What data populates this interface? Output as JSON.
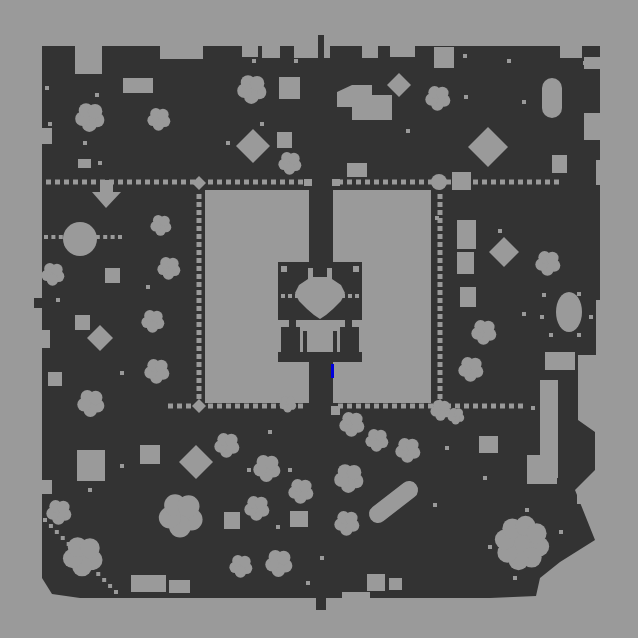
{
  "map": {
    "width": 638,
    "height": 638,
    "colors": {
      "background": "#9a9a9a",
      "terrain": "#333333",
      "clear": "#9a9a9a",
      "marker": "#0000dd"
    },
    "border_polygon": [
      [
        42,
        46
      ],
      [
        600,
        46
      ],
      [
        600,
        300
      ],
      [
        596,
        300
      ],
      [
        596,
        355
      ],
      [
        578,
        355
      ],
      [
        578,
        420
      ],
      [
        595,
        432
      ],
      [
        595,
        470
      ],
      [
        575,
        490
      ],
      [
        595,
        540
      ],
      [
        560,
        562
      ],
      [
        540,
        578
      ],
      [
        536,
        596
      ],
      [
        490,
        598
      ],
      [
        80,
        598
      ],
      [
        52,
        594
      ],
      [
        42,
        578
      ]
    ],
    "notches": [
      [
        75,
        46,
        27,
        28
      ],
      [
        160,
        46,
        43,
        13
      ],
      [
        242,
        46,
        16,
        11
      ],
      [
        262,
        46,
        18,
        12
      ],
      [
        294,
        46,
        36,
        12
      ],
      [
        362,
        46,
        16,
        12
      ],
      [
        390,
        46,
        25,
        11
      ],
      [
        560,
        46,
        22,
        12
      ],
      [
        584,
        57,
        16,
        12
      ],
      [
        584,
        113,
        16,
        27
      ],
      [
        596,
        160,
        8,
        25
      ],
      [
        42,
        128,
        10,
        16
      ],
      [
        42,
        330,
        8,
        18
      ],
      [
        42,
        480,
        10,
        14
      ],
      [
        527,
        455,
        30,
        29
      ],
      [
        577,
        488,
        18,
        16
      ],
      [
        342,
        592,
        28,
        8
      ]
    ],
    "stubs": [
      [
        318,
        35,
        6,
        24
      ],
      [
        316,
        596,
        10,
        14
      ],
      [
        34,
        298,
        8,
        10
      ]
    ],
    "courtyards": [
      [
        205,
        190,
        104,
        213
      ],
      [
        333,
        190,
        98,
        213
      ]
    ],
    "colonnade": {
      "pillar_radius": 7,
      "corner_pillars": [
        [
          199,
          183
        ],
        [
          440,
          183
        ],
        [
          199,
          406
        ],
        [
          440,
          406
        ]
      ],
      "dot_rows": [
        {
          "y": 182,
          "step": 9,
          "size": 5,
          "segments": [
            [
              46,
              194
            ],
            [
              208,
              302
            ],
            [
              338,
              430
            ],
            [
              446,
              560
            ]
          ]
        },
        {
          "y": 406,
          "step": 9,
          "size": 5,
          "segments": [
            [
              168,
              194
            ],
            [
              208,
              302
            ],
            [
              338,
              430
            ],
            [
              446,
              518
            ]
          ]
        }
      ],
      "dot_cols": [
        {
          "x": 199,
          "step": 8,
          "size": 5,
          "segments": [
            [
              194,
              400
            ]
          ]
        },
        {
          "x": 440,
          "step": 8,
          "size": 5,
          "segments": [
            [
              194,
              400
            ]
          ]
        }
      ]
    },
    "dotted_paths": [
      {
        "from": [
          46,
          237
        ],
        "to": [
          120,
          237
        ],
        "step": 7,
        "size": 4
      },
      {
        "from": [
          45,
          520
        ],
        "to": [
          116,
          592
        ],
        "step": 8,
        "size": 4
      }
    ],
    "building": {
      "body": [
        278,
        262,
        84,
        100
      ],
      "fan": [
        [
          308,
          268
        ],
        [
          313,
          268
        ],
        [
          313,
          277
        ],
        [
          327,
          277
        ],
        [
          327,
          268
        ],
        [
          332,
          268
        ],
        [
          332,
          279
        ],
        [
          341,
          285
        ],
        [
          345,
          293
        ],
        [
          341,
          301
        ],
        [
          333,
          309
        ],
        [
          326,
          315
        ],
        [
          320,
          319
        ],
        [
          314,
          315
        ],
        [
          307,
          309
        ],
        [
          299,
          301
        ],
        [
          295,
          293
        ],
        [
          299,
          285
        ],
        [
          308,
          279
        ]
      ],
      "squares": [
        [
          281,
          266,
          6,
          6
        ],
        [
          353,
          266,
          6,
          6
        ]
      ],
      "pillar_dots": [
        [
          283,
          296
        ],
        [
          290,
          296
        ],
        [
          297,
          296
        ],
        [
          343,
          296
        ],
        [
          350,
          296
        ],
        [
          357,
          296
        ]
      ],
      "band": [
        277,
        320,
        86,
        7
      ],
      "band_gaps": [
        [
          289,
          320,
          7,
          7
        ],
        [
          345,
          320,
          7,
          7
        ]
      ],
      "room": [
        300,
        325,
        40,
        27
      ],
      "room_columns": [
        [
          303,
          331,
          4,
          21
        ],
        [
          333,
          331,
          4,
          21
        ]
      ],
      "side_strips": [
        [
          277,
          325,
          4,
          27
        ],
        [
          359,
          325,
          4,
          27
        ]
      ]
    },
    "marker": [
      331,
      364,
      3,
      14
    ],
    "blobs": [
      {
        "shape": "rect",
        "x": 123,
        "y": 78,
        "w": 30,
        "h": 15
      },
      {
        "shape": "tree",
        "cx": 159,
        "cy": 119,
        "r": 11
      },
      {
        "shape": "tree",
        "cx": 90,
        "cy": 117,
        "r": 14
      },
      {
        "shape": "rect",
        "x": 78,
        "y": 159,
        "w": 13,
        "h": 9
      },
      {
        "shape": "poly",
        "pts": [
          [
            100,
            180
          ],
          [
            113,
            180
          ],
          [
            113,
            192
          ],
          [
            121,
            192
          ],
          [
            106,
            208
          ],
          [
            92,
            192
          ],
          [
            100,
            192
          ]
        ]
      },
      {
        "shape": "tree",
        "cx": 53,
        "cy": 274,
        "r": 11
      },
      {
        "shape": "circle",
        "cx": 80,
        "cy": 239,
        "r": 17
      },
      {
        "shape": "rect",
        "x": 105,
        "y": 268,
        "w": 15,
        "h": 15
      },
      {
        "shape": "tree",
        "cx": 161,
        "cy": 225,
        "r": 10
      },
      {
        "shape": "tree",
        "cx": 169,
        "cy": 268,
        "r": 11
      },
      {
        "shape": "rect",
        "x": 75,
        "y": 315,
        "w": 15,
        "h": 15
      },
      {
        "shape": "diamond",
        "cx": 100,
        "cy": 338,
        "r": 13
      },
      {
        "shape": "tree",
        "cx": 153,
        "cy": 321,
        "r": 11
      },
      {
        "shape": "tree",
        "cx": 157,
        "cy": 371,
        "r": 12
      },
      {
        "shape": "rect",
        "x": 48,
        "y": 372,
        "w": 14,
        "h": 14
      },
      {
        "shape": "tree",
        "cx": 91,
        "cy": 403,
        "r": 13
      },
      {
        "shape": "rect",
        "x": 77,
        "y": 450,
        "w": 28,
        "h": 31
      },
      {
        "shape": "tree",
        "cx": 59,
        "cy": 512,
        "r": 12
      },
      {
        "shape": "tree",
        "cx": 83,
        "cy": 556,
        "r": 19
      },
      {
        "shape": "rect",
        "x": 140,
        "y": 445,
        "w": 20,
        "h": 19
      },
      {
        "shape": "diamond",
        "cx": 196,
        "cy": 462,
        "r": 17
      },
      {
        "shape": "tree",
        "cx": 181,
        "cy": 515,
        "r": 21
      },
      {
        "shape": "rect",
        "x": 131,
        "y": 575,
        "w": 35,
        "h": 17
      },
      {
        "shape": "rect",
        "x": 169,
        "y": 580,
        "w": 21,
        "h": 13
      },
      {
        "shape": "tree",
        "cx": 252,
        "cy": 89,
        "r": 14
      },
      {
        "shape": "rect",
        "x": 279,
        "y": 77,
        "w": 21,
        "h": 22
      },
      {
        "shape": "poly",
        "pts": [
          [
            337,
            92
          ],
          [
            352,
            85
          ],
          [
            372,
            85
          ],
          [
            372,
            95
          ],
          [
            392,
            95
          ],
          [
            392,
            120
          ],
          [
            352,
            120
          ],
          [
            352,
            107
          ],
          [
            337,
            107
          ]
        ]
      },
      {
        "shape": "diamond",
        "cx": 399,
        "cy": 85,
        "r": 12
      },
      {
        "shape": "diamond",
        "cx": 253,
        "cy": 146,
        "r": 17
      },
      {
        "shape": "rect",
        "x": 277,
        "y": 132,
        "w": 15,
        "h": 16
      },
      {
        "shape": "tree",
        "cx": 290,
        "cy": 163,
        "r": 11
      },
      {
        "shape": "rect",
        "x": 347,
        "y": 163,
        "w": 20,
        "h": 14
      },
      {
        "shape": "rect",
        "x": 434,
        "y": 47,
        "w": 20,
        "h": 21
      },
      {
        "shape": "tree",
        "cx": 438,
        "cy": 98,
        "r": 12
      },
      {
        "shape": "pill",
        "x": 542,
        "y": 78,
        "w": 20,
        "h": 40
      },
      {
        "shape": "diamond",
        "cx": 488,
        "cy": 147,
        "r": 20
      },
      {
        "shape": "rect",
        "x": 452,
        "y": 172,
        "w": 19,
        "h": 18
      },
      {
        "shape": "circle",
        "cx": 439,
        "cy": 182,
        "r": 8
      },
      {
        "shape": "rect",
        "x": 552,
        "y": 155,
        "w": 15,
        "h": 18
      },
      {
        "shape": "rect",
        "x": 457,
        "y": 220,
        "w": 19,
        "h": 29
      },
      {
        "shape": "rect",
        "x": 457,
        "y": 252,
        "w": 17,
        "h": 22
      },
      {
        "shape": "rect",
        "x": 460,
        "y": 287,
        "w": 16,
        "h": 20
      },
      {
        "shape": "diamond",
        "cx": 504,
        "cy": 252,
        "r": 15
      },
      {
        "shape": "tree",
        "cx": 548,
        "cy": 263,
        "r": 12
      },
      {
        "shape": "oval",
        "cx": 569,
        "cy": 312,
        "rx": 13,
        "ry": 20
      },
      {
        "shape": "tree",
        "cx": 484,
        "cy": 332,
        "r": 12
      },
      {
        "shape": "tree",
        "cx": 471,
        "cy": 369,
        "r": 12
      },
      {
        "shape": "rect",
        "x": 545,
        "y": 352,
        "w": 30,
        "h": 18
      },
      {
        "shape": "rect",
        "x": 540,
        "y": 380,
        "w": 18,
        "h": 98
      },
      {
        "shape": "rect",
        "x": 528,
        "y": 460,
        "w": 14,
        "h": 18
      },
      {
        "shape": "tree",
        "cx": 441,
        "cy": 410,
        "r": 10
      },
      {
        "shape": "tree",
        "cx": 456,
        "cy": 416,
        "r": 8
      },
      {
        "shape": "rect",
        "x": 331,
        "y": 406,
        "w": 9,
        "h": 9
      },
      {
        "shape": "tree",
        "cx": 288,
        "cy": 404,
        "r": 8
      },
      {
        "shape": "tree",
        "cx": 352,
        "cy": 424,
        "r": 12
      },
      {
        "shape": "rect",
        "x": 304,
        "y": 179,
        "w": 8,
        "h": 7
      },
      {
        "shape": "rect",
        "x": 332,
        "y": 179,
        "w": 8,
        "h": 7
      },
      {
        "shape": "tree",
        "cx": 227,
        "cy": 445,
        "r": 12
      },
      {
        "shape": "tree",
        "cx": 267,
        "cy": 468,
        "r": 13
      },
      {
        "shape": "tree",
        "cx": 301,
        "cy": 491,
        "r": 12
      },
      {
        "shape": "tree",
        "cx": 257,
        "cy": 508,
        "r": 12
      },
      {
        "shape": "rect",
        "x": 224,
        "y": 512,
        "w": 16,
        "h": 17
      },
      {
        "shape": "rect",
        "x": 290,
        "y": 511,
        "w": 18,
        "h": 16
      },
      {
        "shape": "tree",
        "cx": 349,
        "cy": 478,
        "r": 14
      },
      {
        "shape": "tree",
        "cx": 347,
        "cy": 523,
        "r": 12
      },
      {
        "shape": "capsule",
        "x1": 378,
        "y1": 514,
        "x2": 409,
        "y2": 490,
        "r": 9
      },
      {
        "shape": "tree",
        "cx": 377,
        "cy": 440,
        "r": 11
      },
      {
        "shape": "tree",
        "cx": 408,
        "cy": 450,
        "r": 12
      },
      {
        "shape": "tree",
        "cx": 279,
        "cy": 563,
        "r": 13
      },
      {
        "shape": "tree",
        "cx": 241,
        "cy": 566,
        "r": 11
      },
      {
        "shape": "rect",
        "x": 367,
        "y": 574,
        "w": 18,
        "h": 17
      },
      {
        "shape": "rect",
        "x": 389,
        "y": 578,
        "w": 13,
        "h": 12
      },
      {
        "shape": "rect",
        "x": 479,
        "y": 436,
        "w": 19,
        "h": 17
      },
      {
        "shape": "flower",
        "cx": 522,
        "cy": 543,
        "r": 25
      }
    ],
    "dots": [
      [
        47,
        88
      ],
      [
        97,
        95
      ],
      [
        50,
        124
      ],
      [
        85,
        143
      ],
      [
        100,
        163
      ],
      [
        148,
        287
      ],
      [
        58,
        300
      ],
      [
        122,
        373
      ],
      [
        90,
        490
      ],
      [
        122,
        466
      ],
      [
        228,
        143
      ],
      [
        262,
        124
      ],
      [
        254,
        61
      ],
      [
        296,
        61
      ],
      [
        374,
        108
      ],
      [
        374,
        115
      ],
      [
        408,
        131
      ],
      [
        270,
        432
      ],
      [
        249,
        470
      ],
      [
        290,
        470
      ],
      [
        278,
        527
      ],
      [
        322,
        558
      ],
      [
        308,
        583
      ],
      [
        465,
        56
      ],
      [
        509,
        61
      ],
      [
        524,
        102
      ],
      [
        466,
        97
      ],
      [
        585,
        63
      ],
      [
        437,
        218
      ],
      [
        500,
        231
      ],
      [
        524,
        314
      ],
      [
        544,
        295
      ],
      [
        579,
        294
      ],
      [
        542,
        317
      ],
      [
        591,
        317
      ],
      [
        551,
        335
      ],
      [
        579,
        335
      ],
      [
        533,
        408
      ],
      [
        447,
        448
      ],
      [
        485,
        478
      ],
      [
        435,
        505
      ],
      [
        527,
        510
      ],
      [
        561,
        532
      ],
      [
        490,
        547
      ],
      [
        515,
        578
      ]
    ]
  }
}
